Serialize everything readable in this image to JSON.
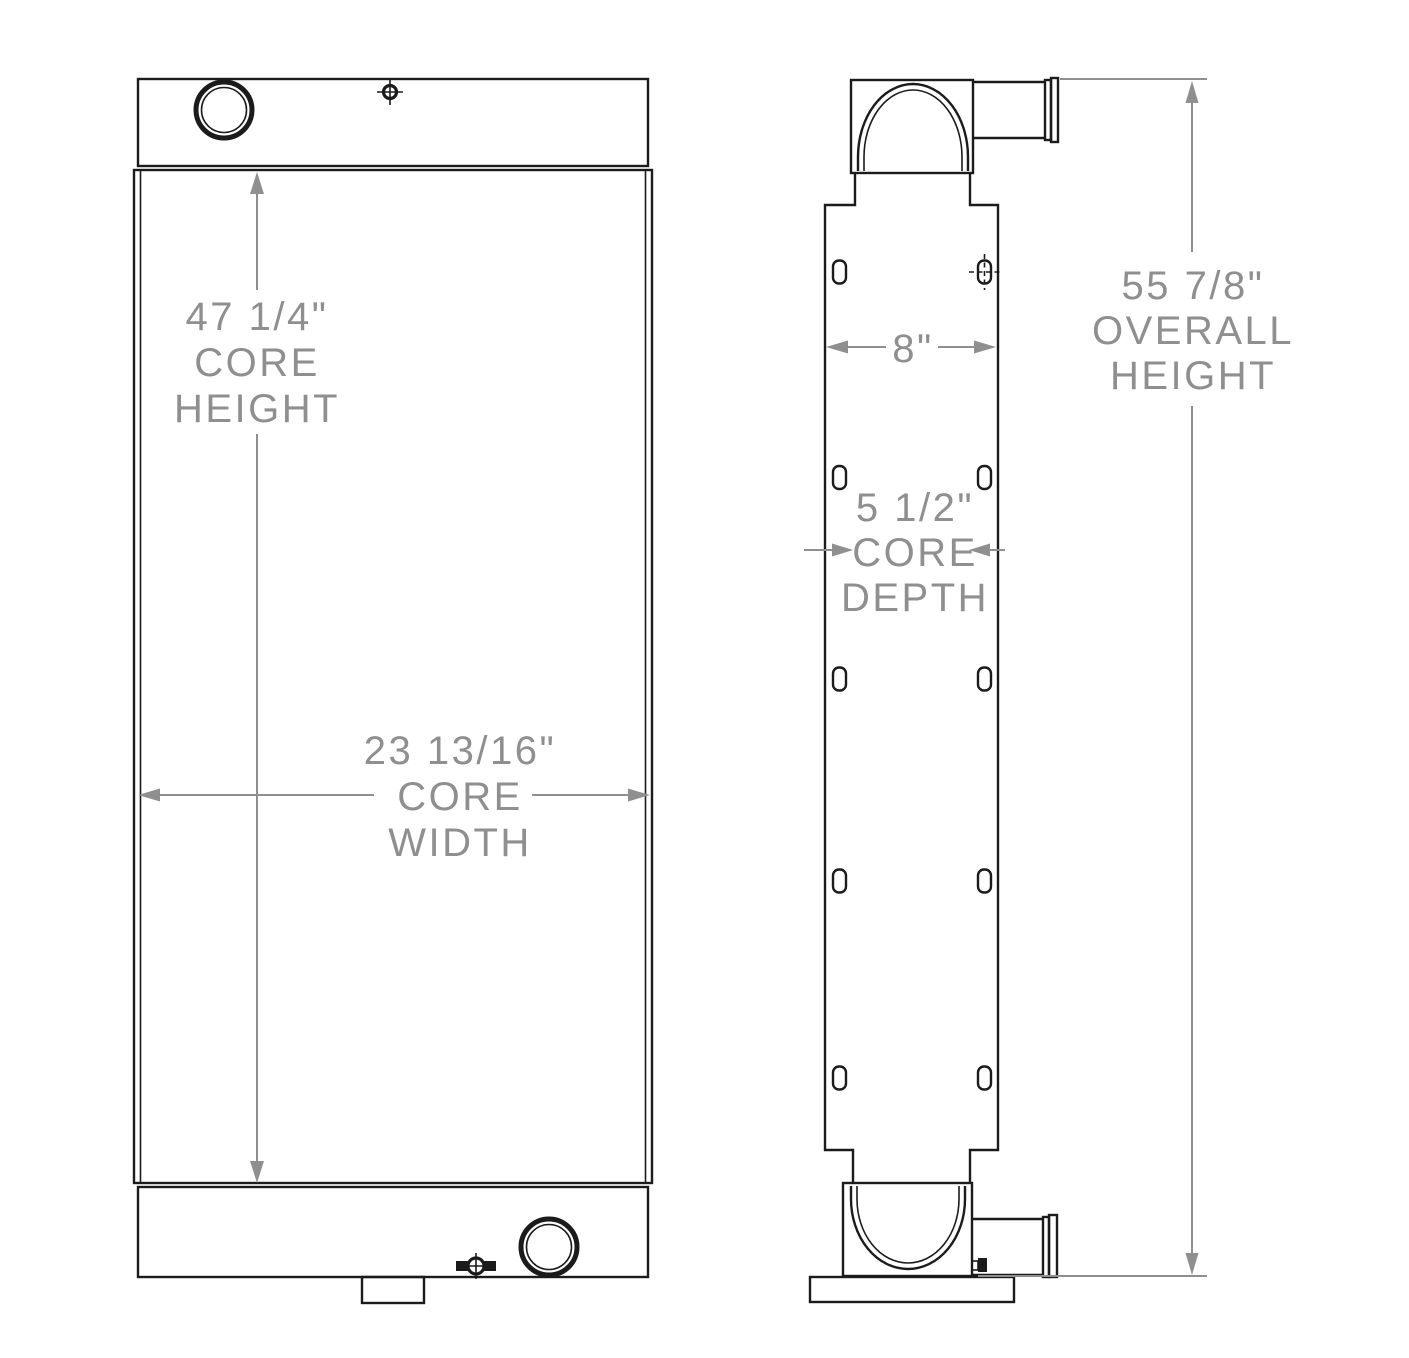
{
  "drawing": {
    "front_view": {
      "core_height_value": "47 1/4\"",
      "core_height_label1": "CORE",
      "core_height_label2": "HEIGHT",
      "core_width_value": "23 13/16\"",
      "core_width_label1": "CORE",
      "core_width_label2": "WIDTH"
    },
    "side_view": {
      "tank_width_value": "8\"",
      "core_depth_value": "5 1/2\"",
      "core_depth_label1": "CORE",
      "core_depth_label2": "DEPTH",
      "overall_height_value": "55 7/8\"",
      "overall_height_label1": "OVERALL",
      "overall_height_label2": "HEIGHT"
    },
    "colors": {
      "line": "#1b1b1b",
      "dimension": "#8f8f8f",
      "background": "#ffffff"
    }
  }
}
